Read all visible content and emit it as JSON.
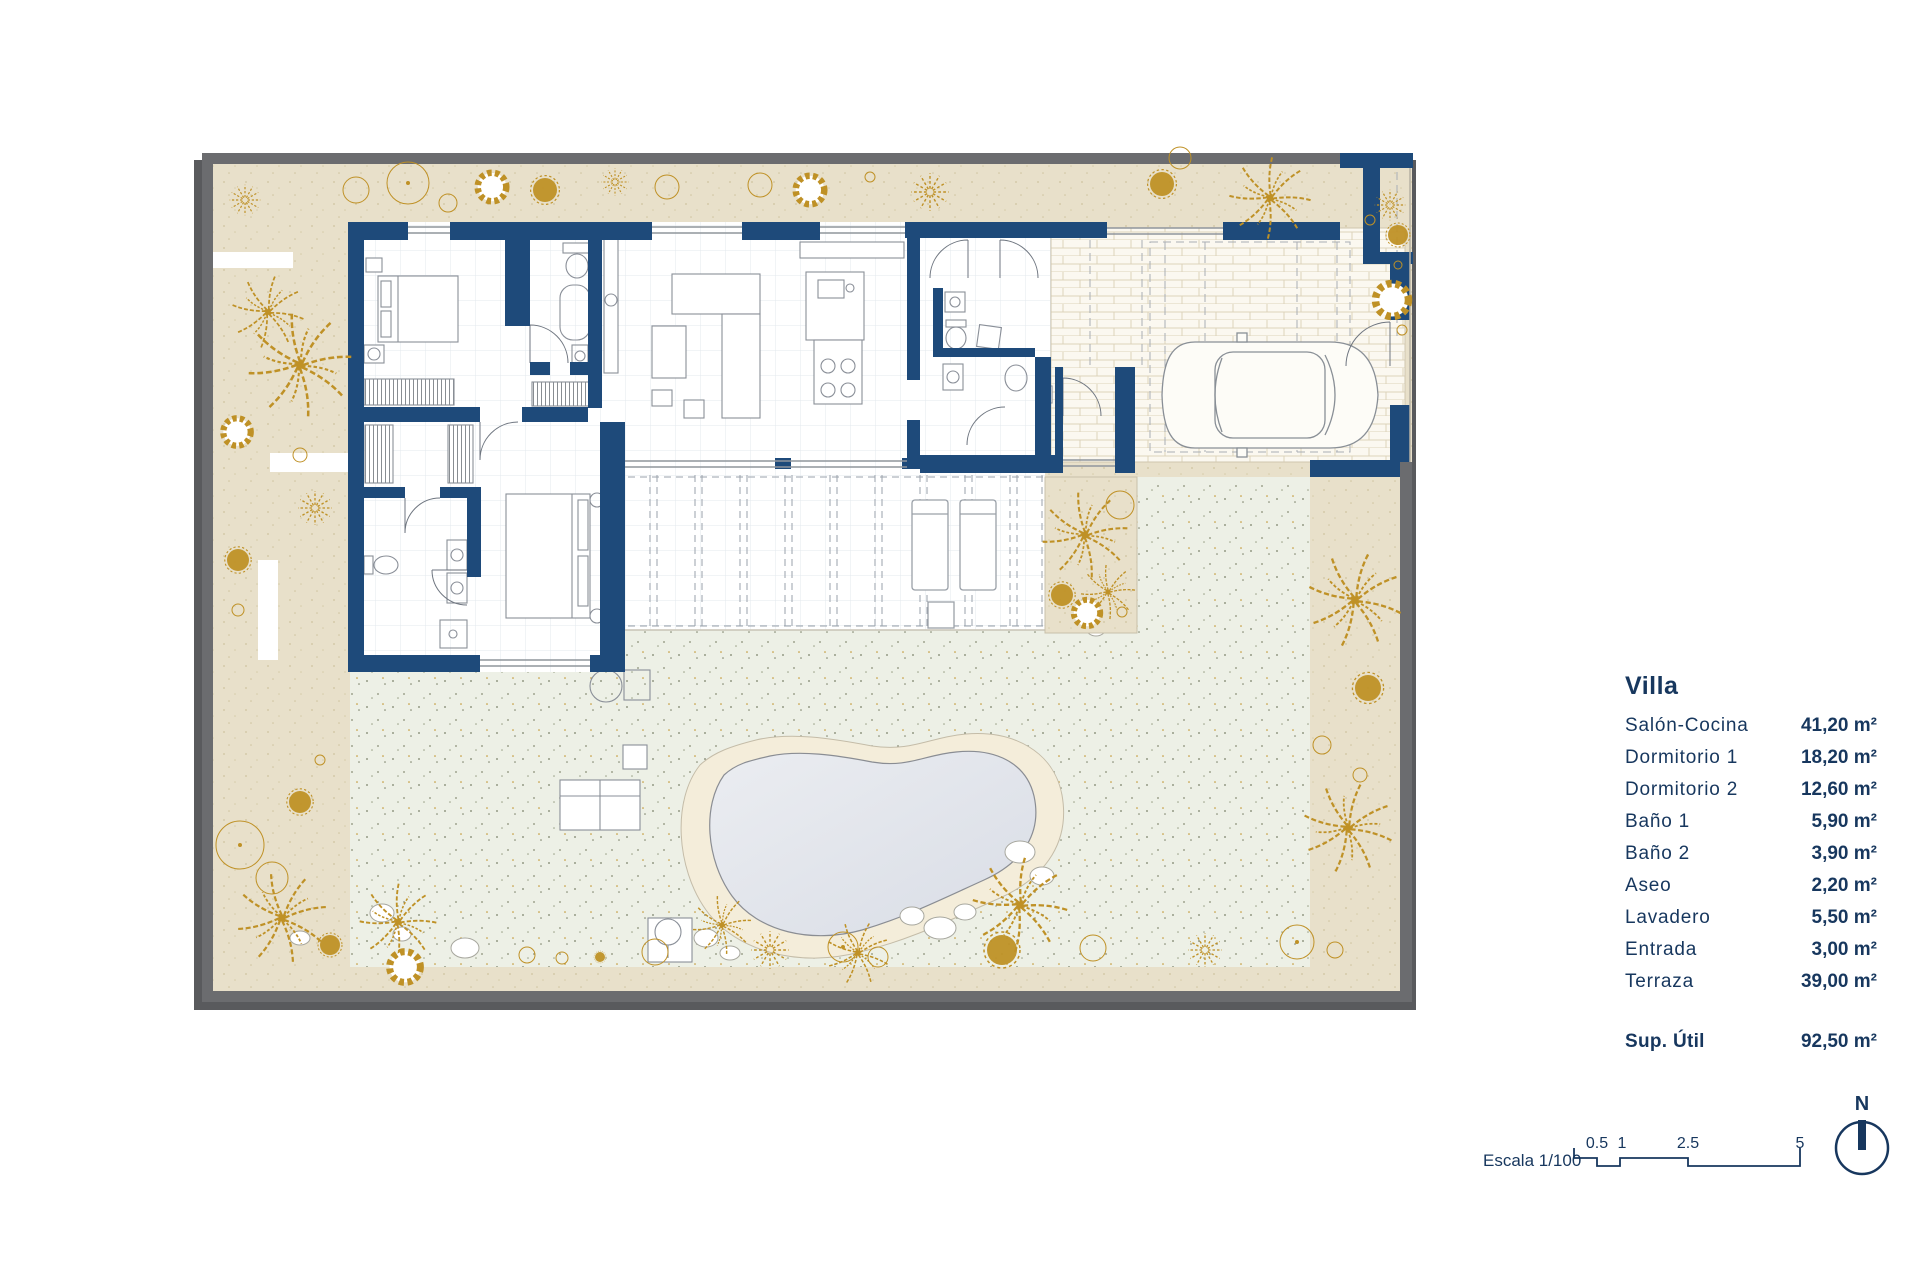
{
  "legend": {
    "title": "Villa",
    "rows": [
      {
        "label": "Salón-Cocina",
        "value": "41,20 m²"
      },
      {
        "label": "Dormitorio 1",
        "value": "18,20 m²"
      },
      {
        "label": "Dormitorio 2",
        "value": "12,60 m²"
      },
      {
        "label": "Baño 1",
        "value": "5,90 m²"
      },
      {
        "label": "Baño 2",
        "value": "3,90 m²"
      },
      {
        "label": "Aseo",
        "value": "2,20 m²"
      },
      {
        "label": "Lavadero",
        "value": "5,50 m²"
      },
      {
        "label": "Entrada",
        "value": "3,00 m²"
      },
      {
        "label": "Terraza",
        "value": "39,00 m²"
      }
    ],
    "total": {
      "label": "Sup. Útil",
      "value": "92,50 m²"
    }
  },
  "scale_bar": {
    "label": "Escala 1/100",
    "ticks": [
      "0.5",
      "1",
      "2.5",
      "5"
    ]
  },
  "compass": {
    "label": "N"
  },
  "colors": {
    "wall": "#1e4a7a",
    "frame": "#6b6c6f",
    "sand": "#e8e0ca",
    "lawn": "#edf0e6",
    "gold": "#bf9126",
    "water1": "#ebedf1",
    "water2": "#d9dde6",
    "navy": "#17375e",
    "tile": "#ddd3ba"
  }
}
